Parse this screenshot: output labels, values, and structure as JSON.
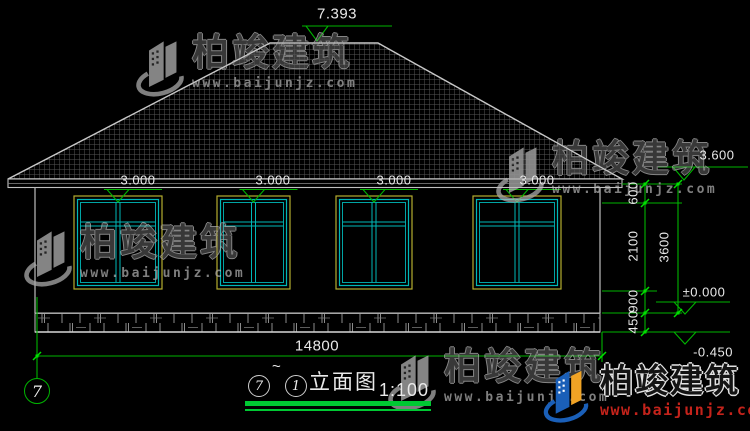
{
  "watermark": {
    "brand": "柏竣建筑",
    "site": "www.baijunjz.com"
  },
  "annotations": {
    "ridge_elev": "7.393",
    "lintel_elev": "3.000",
    "eave_elev": "3.600",
    "floor_elev": "±0.000",
    "ground_elev": "-0.450",
    "dim_total": "14800",
    "dim_eave_to_lintel": "600",
    "dim_window_height": "2100",
    "dim_storey": "3600",
    "dim_sill": "900",
    "dim_plinth": "450",
    "axis_left": "7"
  },
  "title": {
    "axis_start": "7",
    "separator": "~",
    "axis_end": "1",
    "label": "立面图",
    "scale": "1:100"
  }
}
